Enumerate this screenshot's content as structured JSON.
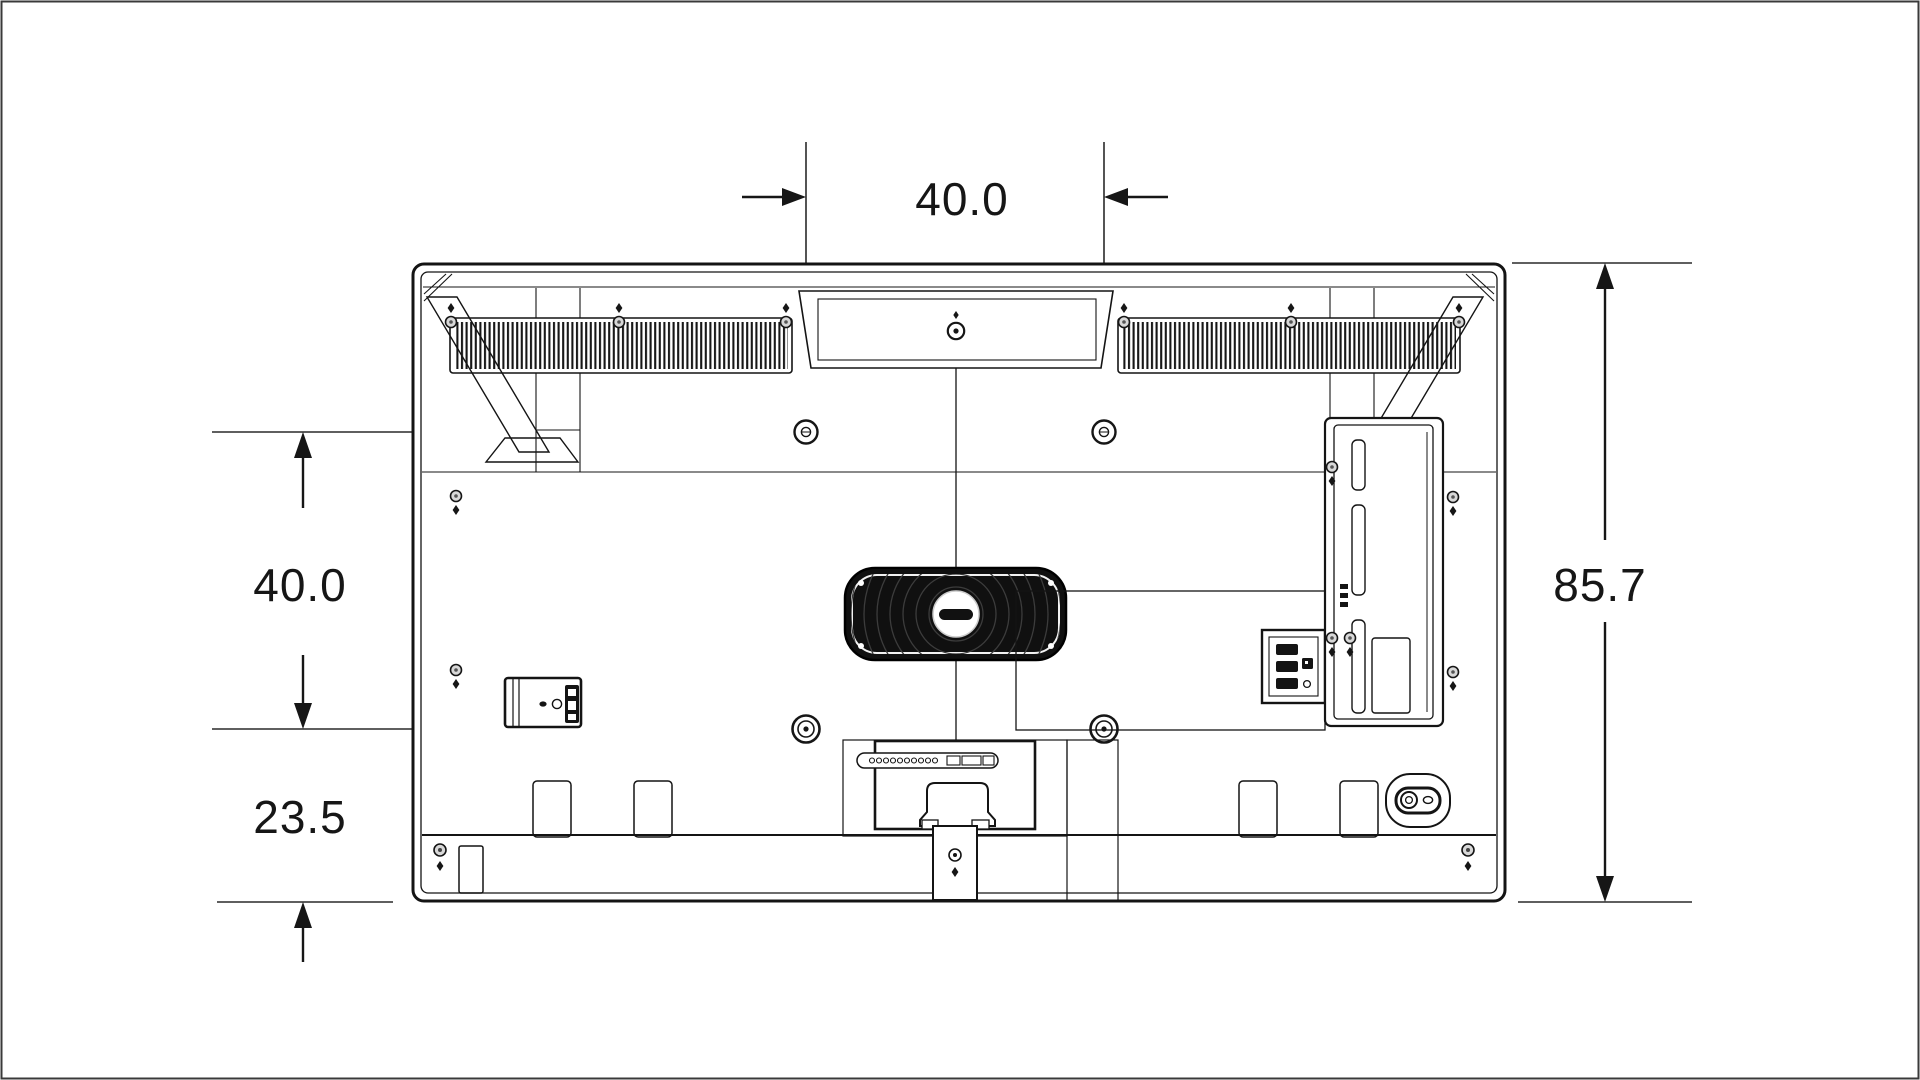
{
  "page": {
    "background": "#ffffff",
    "line_color": "#161616",
    "dim_line_color": "#2a2a2a",
    "border_color": "#3a3a3a"
  },
  "diagram": {
    "type": "technical-drawing",
    "subject": "tv-rear-panel-dimension-diagram",
    "dimensions": {
      "vesa_width": "40.0",
      "vesa_height": "40.0",
      "bottom_offset": "23.5",
      "total_height": "85.7"
    },
    "features": [
      "top-left-cooling-vent",
      "top-right-cooling-vent",
      "center-handle-recess",
      "vesa-mount-holes",
      "center-woofer-speaker",
      "side-connector-box",
      "rear-connector-panel",
      "terminal-cover",
      "stand-column",
      "antenna-terminal"
    ]
  }
}
